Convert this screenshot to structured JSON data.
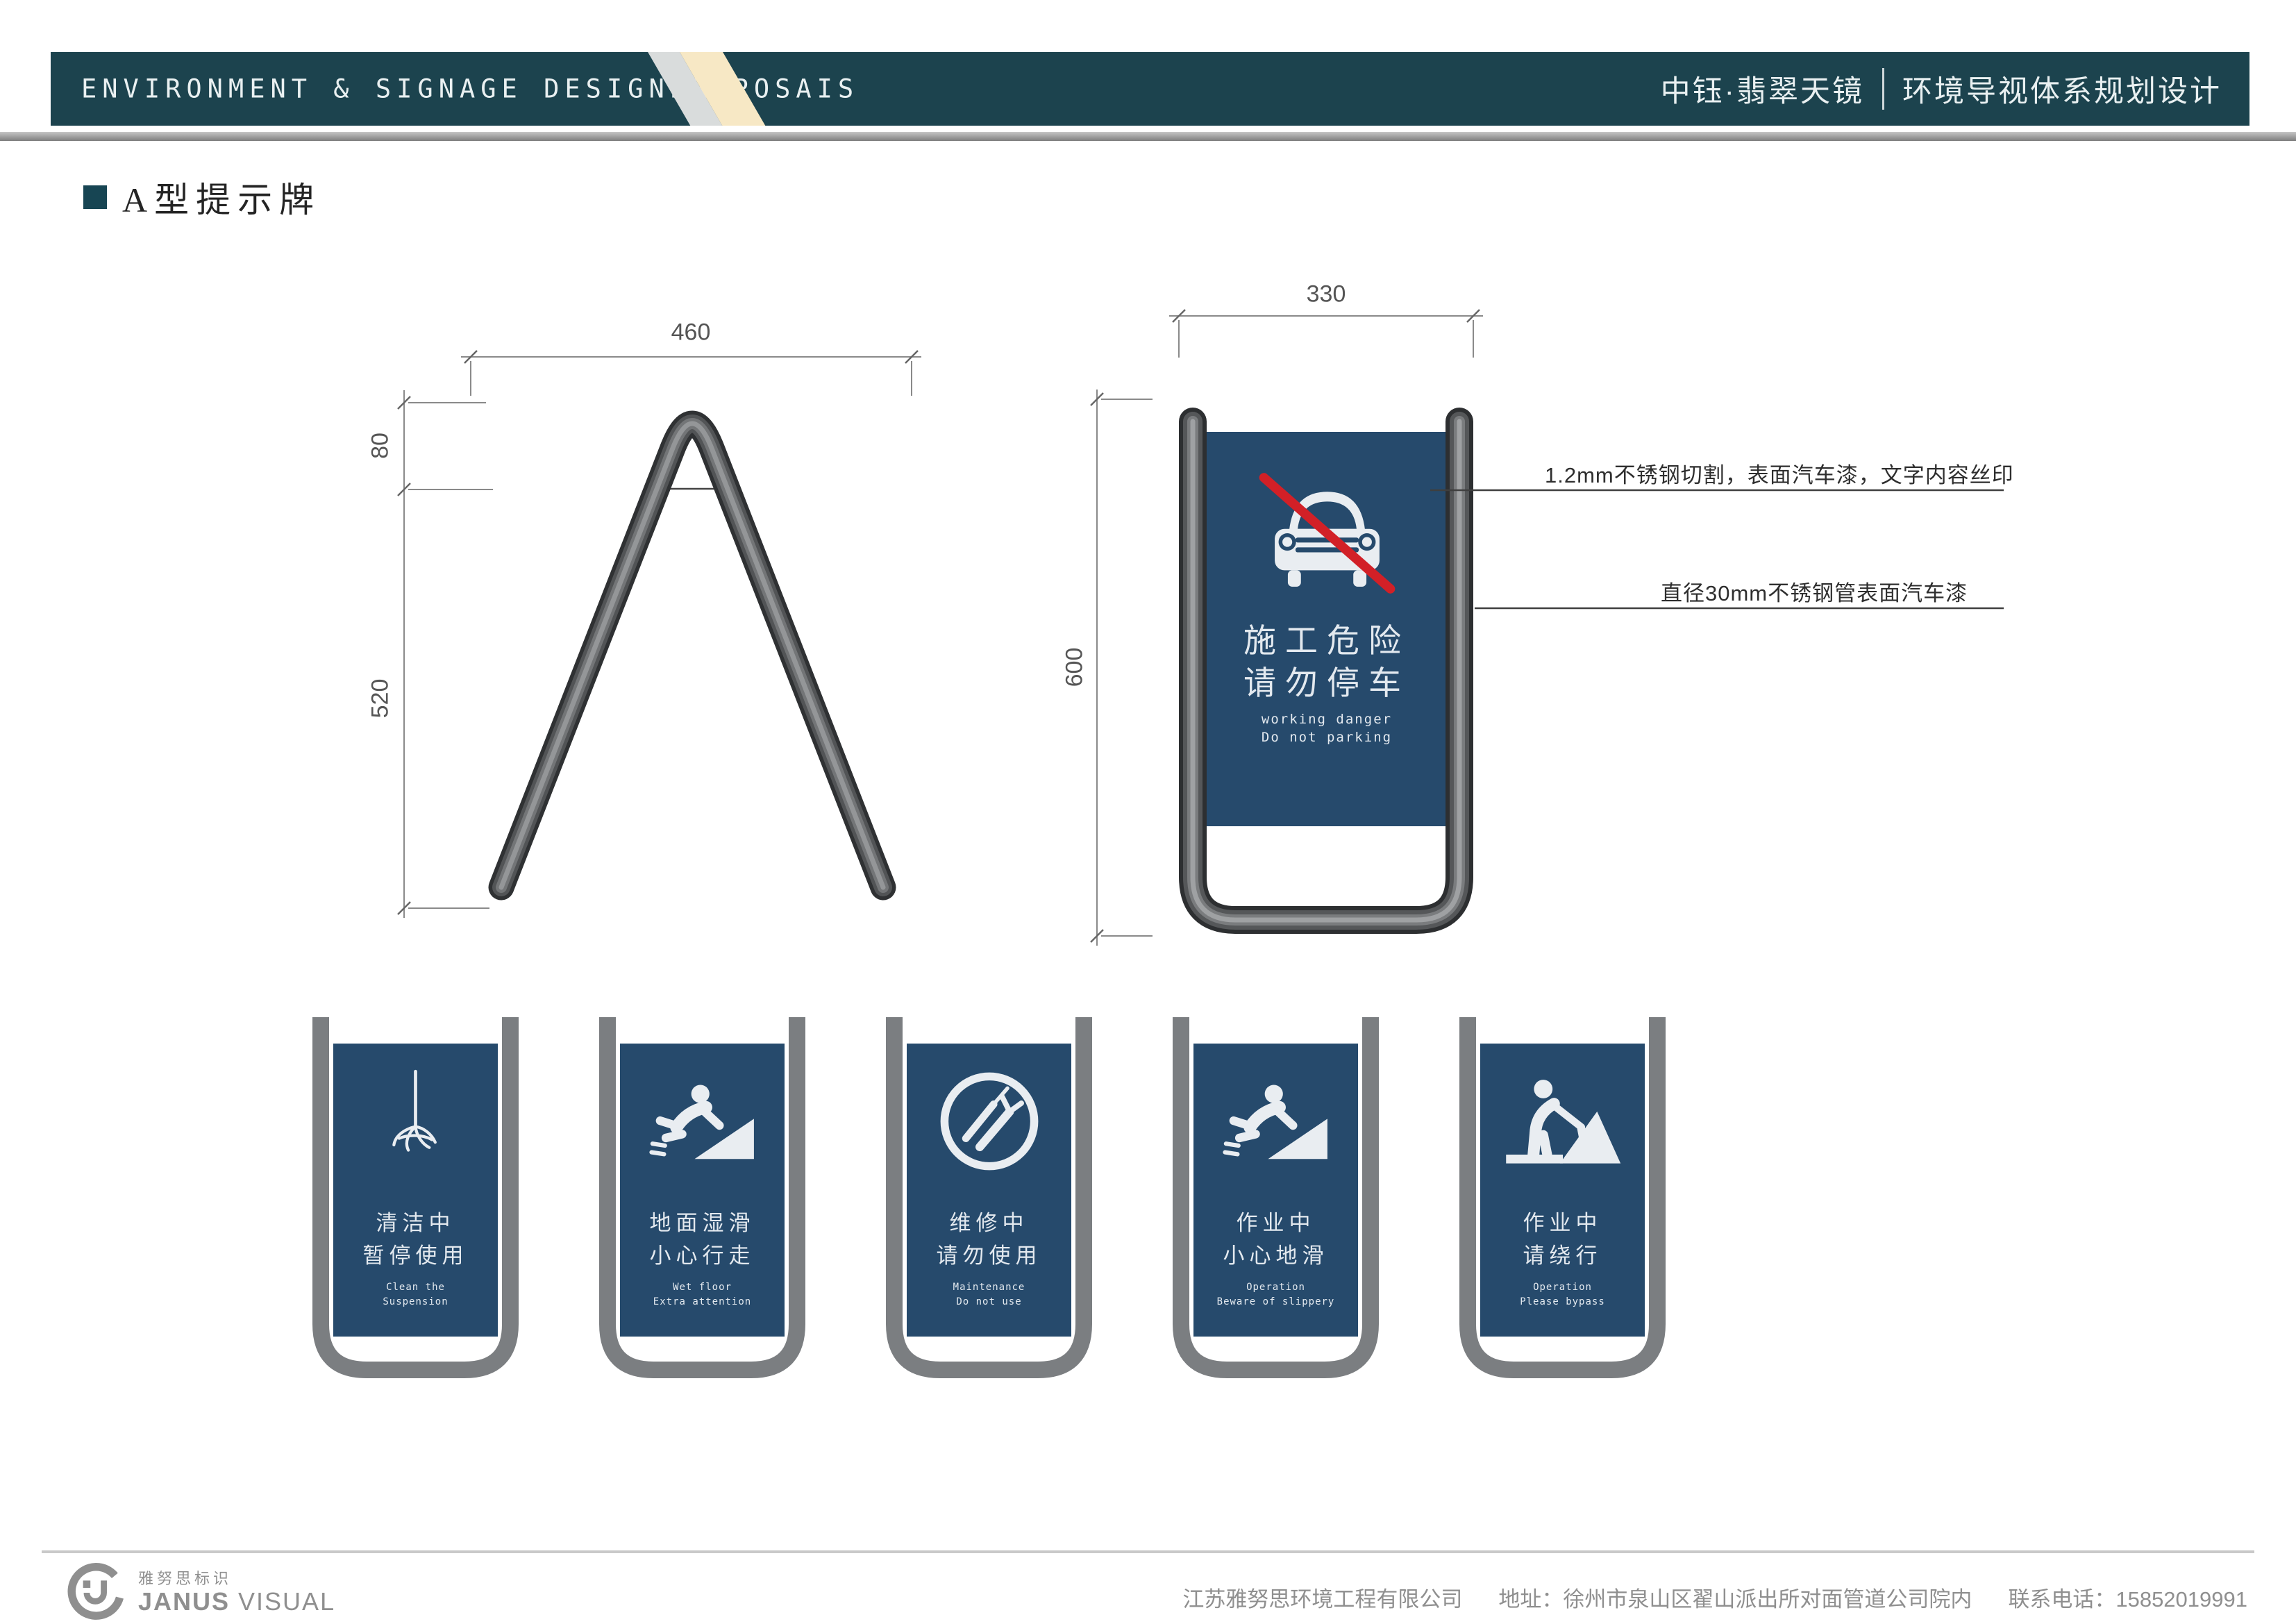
{
  "header": {
    "title_en": "ENVIRONMENT & SIGNAGE DESIGNPROPOSAIS",
    "project_name": "中钰·翡翠天镜",
    "subtitle": "环境导视体系规划设计"
  },
  "section": {
    "title": "A型提示牌"
  },
  "side_view": {
    "dim_width": "460",
    "dim_top": "80",
    "dim_bottom": "520"
  },
  "front_view": {
    "dim_width": "330",
    "dim_height": "600",
    "panel": {
      "icon": "no-parking-car-icon",
      "cn_line1": "施工危险",
      "cn_line2": "请勿停车",
      "en_line1": "working danger",
      "en_line2": "Do not parking"
    }
  },
  "annotations": {
    "panel_note": "1.2mm不锈钢切割，表面汽车漆，文字内容丝印",
    "tube_note": "直径30mm不锈钢管表面汽车漆"
  },
  "small_signs": [
    {
      "icon": "mop-icon",
      "cn_line1": "清洁中",
      "cn_line2": "暂停使用",
      "en_line1": "Clean the",
      "en_line2": "Suspension"
    },
    {
      "icon": "slip-icon",
      "cn_line1": "地面湿滑",
      "cn_line2": "小心行走",
      "en_line1": "Wet floor",
      "en_line2": "Extra attention"
    },
    {
      "icon": "maintenance-icon",
      "cn_line1": "维修中",
      "cn_line2": "请勿使用",
      "en_line1": "Maintenance",
      "en_line2": "Do not use"
    },
    {
      "icon": "slip-icon",
      "cn_line1": "作业中",
      "cn_line2": "小心地滑",
      "en_line1": "Operation",
      "en_line2": "Beware of slippery"
    },
    {
      "icon": "construction-worker-icon",
      "cn_line1": "作业中",
      "cn_line2": "请绕行",
      "en_line1": "Operation",
      "en_line2": "Please bypass"
    }
  ],
  "footer": {
    "logo_cn": "雅努思标识",
    "logo_en_bold": "JANUS",
    "logo_en_rest": " VISUAL",
    "company": "江苏雅努思环境工程有限公司",
    "address": "地址：徐州市泉山区翟山派出所对面管道公司院内",
    "phone": "联系电话：15852019991"
  },
  "colors": {
    "header_teal": "#1c434e",
    "panel_blue": "#264a6c",
    "frame_gray": "#7b7e81",
    "stripe_gray": "#d9dcdc",
    "stripe_cream": "#f7e8c5",
    "no_parking_red": "#d22027"
  }
}
